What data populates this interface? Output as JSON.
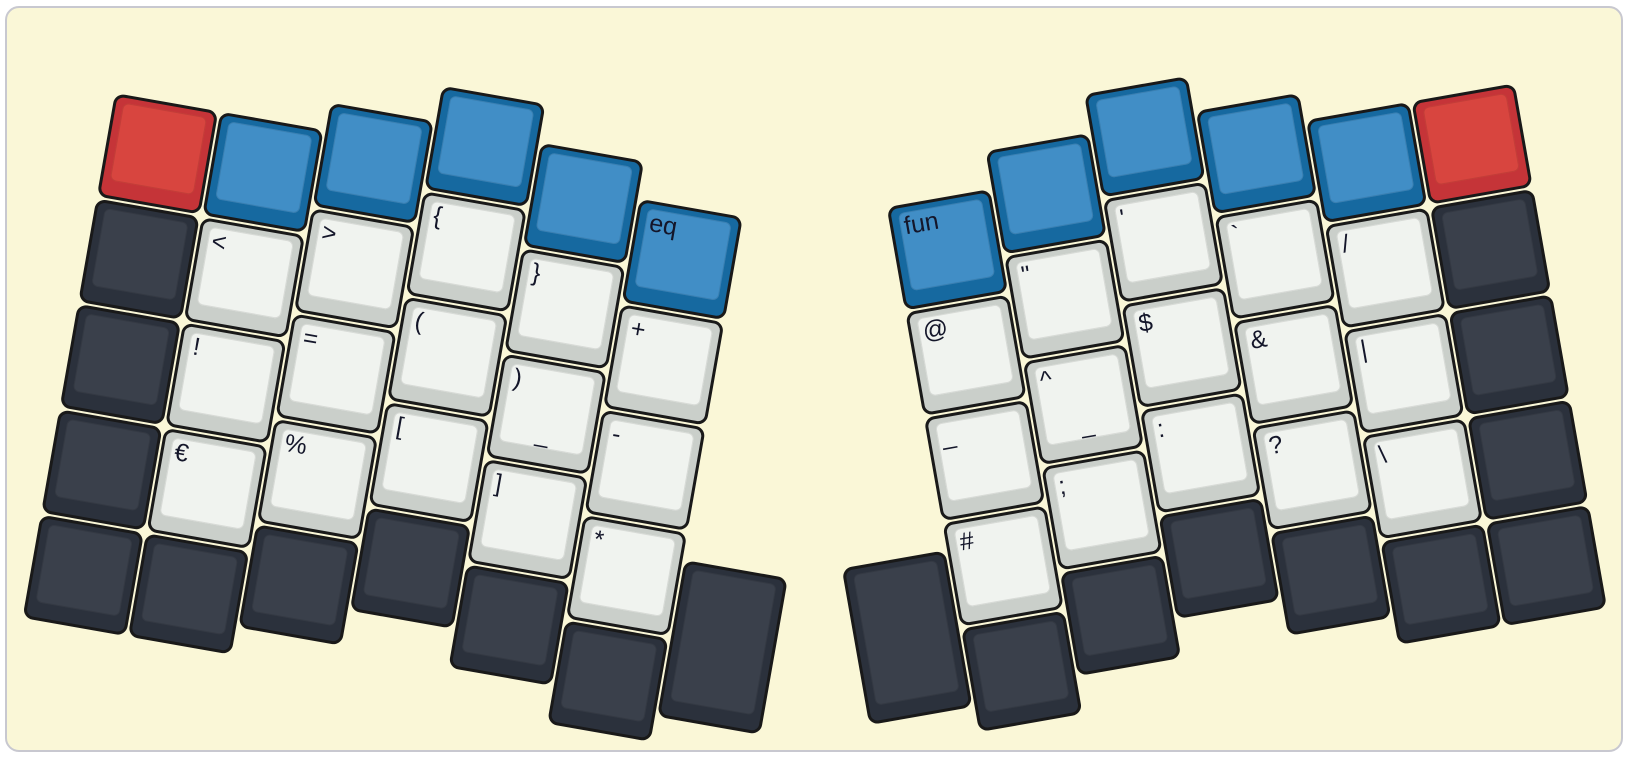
{
  "canvas": {
    "page_background": "#ffffff",
    "panel_fill": "#faf7d7",
    "panel_border": "#c8c8d0"
  },
  "palette": {
    "red": {
      "base": "#c53438",
      "top": "#d8453f"
    },
    "blue": {
      "base": "#1669a0",
      "top": "#418ec6"
    },
    "dark": {
      "base": "#2b313c",
      "top": "#3a404b"
    },
    "light": {
      "base": "#cacfca",
      "top": "#f0f3ef"
    }
  },
  "label_color": "#14162a",
  "key_border_color": "#191919",
  "geometry": {
    "unit": 107,
    "key_size": 105
  },
  "halves": [
    {
      "name": "left",
      "angle": 10,
      "origin_x": 108,
      "origin_y": 85,
      "keys": [
        {
          "x": 0,
          "y": 0,
          "color": "red"
        },
        {
          "x": 0,
          "y": 1,
          "color": "dark"
        },
        {
          "x": 0,
          "y": 2,
          "color": "dark"
        },
        {
          "x": 0,
          "y": 3,
          "color": "dark"
        },
        {
          "x": 0,
          "y": 4,
          "color": "dark"
        },
        {
          "x": 1,
          "y": 0,
          "color": "blue"
        },
        {
          "x": 1,
          "y": 1,
          "color": "light",
          "label": "<"
        },
        {
          "x": 1,
          "y": 2,
          "color": "light",
          "label": "!"
        },
        {
          "x": 1,
          "y": 3,
          "color": "light",
          "label": "€"
        },
        {
          "x": 1,
          "y": 4,
          "color": "dark"
        },
        {
          "x": 2,
          "y": -0.26,
          "color": "blue"
        },
        {
          "x": 2,
          "y": 0.74,
          "color": "light",
          "label": ">"
        },
        {
          "x": 2,
          "y": 1.74,
          "color": "light",
          "label": "="
        },
        {
          "x": 2,
          "y": 2.74,
          "color": "light",
          "label": "%"
        },
        {
          "x": 2,
          "y": 3.74,
          "color": "dark"
        },
        {
          "x": 3,
          "y": -0.6,
          "color": "blue"
        },
        {
          "x": 3,
          "y": 0.4,
          "color": "light",
          "label": "{"
        },
        {
          "x": 3,
          "y": 1.4,
          "color": "light",
          "label": "("
        },
        {
          "x": 3,
          "y": 2.4,
          "color": "light",
          "label": "["
        },
        {
          "x": 3,
          "y": 3.4,
          "color": "dark"
        },
        {
          "x": 4,
          "y": -0.23,
          "color": "blue"
        },
        {
          "x": 4,
          "y": 0.77,
          "color": "light",
          "label": "}"
        },
        {
          "x": 4,
          "y": 1.77,
          "color": "light",
          "label": ")",
          "sub": "_"
        },
        {
          "x": 4,
          "y": 2.77,
          "color": "light",
          "label": "]"
        },
        {
          "x": 4,
          "y": 3.77,
          "color": "dark"
        },
        {
          "x": 5,
          "y": 0.12,
          "color": "blue",
          "label": "eq"
        },
        {
          "x": 5,
          "y": 1.12,
          "color": "light",
          "label": "+"
        },
        {
          "x": 5,
          "y": 2.12,
          "color": "light",
          "label": "-"
        },
        {
          "x": 5,
          "y": 3.12,
          "color": "light",
          "label": "*"
        },
        {
          "x": 5,
          "y": 4.12,
          "color": "dark"
        },
        {
          "x": 6,
          "y": 3.375,
          "h": 1.5,
          "color": "dark"
        }
      ]
    },
    {
      "name": "right",
      "angle": -10,
      "origin_x": 772,
      "origin_y": 205,
      "keys": [
        {
          "x": 0,
          "y": 3.375,
          "h": 1.5,
          "color": "dark"
        },
        {
          "x": 1,
          "y": 0.12,
          "color": "blue",
          "label": "fun"
        },
        {
          "x": 1,
          "y": 1.12,
          "color": "light",
          "label": "@"
        },
        {
          "x": 1,
          "y": 2.12,
          "color": "light",
          "label": "_"
        },
        {
          "x": 1,
          "y": 3.12,
          "color": "light",
          "label": "#"
        },
        {
          "x": 1,
          "y": 4.12,
          "color": "dark"
        },
        {
          "x": 2,
          "y": -0.23,
          "color": "blue"
        },
        {
          "x": 2,
          "y": 0.77,
          "color": "light",
          "label": "\""
        },
        {
          "x": 2,
          "y": 1.77,
          "color": "light",
          "label": "^",
          "sub": "_"
        },
        {
          "x": 2,
          "y": 2.77,
          "color": "light",
          "label": ";"
        },
        {
          "x": 2,
          "y": 3.77,
          "color": "dark"
        },
        {
          "x": 3,
          "y": -0.6,
          "color": "blue"
        },
        {
          "x": 3,
          "y": 0.4,
          "color": "light",
          "label": "'"
        },
        {
          "x": 3,
          "y": 1.4,
          "color": "light",
          "label": "$"
        },
        {
          "x": 3,
          "y": 2.4,
          "color": "light",
          "label": ":"
        },
        {
          "x": 3,
          "y": 3.4,
          "color": "dark"
        },
        {
          "x": 4,
          "y": -0.26,
          "color": "blue"
        },
        {
          "x": 4,
          "y": 0.74,
          "color": "light",
          "label": "`"
        },
        {
          "x": 4,
          "y": 1.74,
          "color": "light",
          "label": "&"
        },
        {
          "x": 4,
          "y": 2.74,
          "color": "light",
          "label": "?"
        },
        {
          "x": 4,
          "y": 3.74,
          "color": "dark"
        },
        {
          "x": 5,
          "y": 0,
          "color": "blue"
        },
        {
          "x": 5,
          "y": 1,
          "color": "light",
          "label": "/"
        },
        {
          "x": 5,
          "y": 2,
          "color": "light",
          "label": "|"
        },
        {
          "x": 5,
          "y": 3,
          "color": "light",
          "label": "\\"
        },
        {
          "x": 5,
          "y": 4,
          "color": "dark"
        },
        {
          "x": 6,
          "y": 0,
          "color": "red"
        },
        {
          "x": 6,
          "y": 1,
          "color": "dark"
        },
        {
          "x": 6,
          "y": 2,
          "color": "dark"
        },
        {
          "x": 6,
          "y": 3,
          "color": "dark"
        },
        {
          "x": 6,
          "y": 4,
          "color": "dark"
        }
      ]
    }
  ]
}
